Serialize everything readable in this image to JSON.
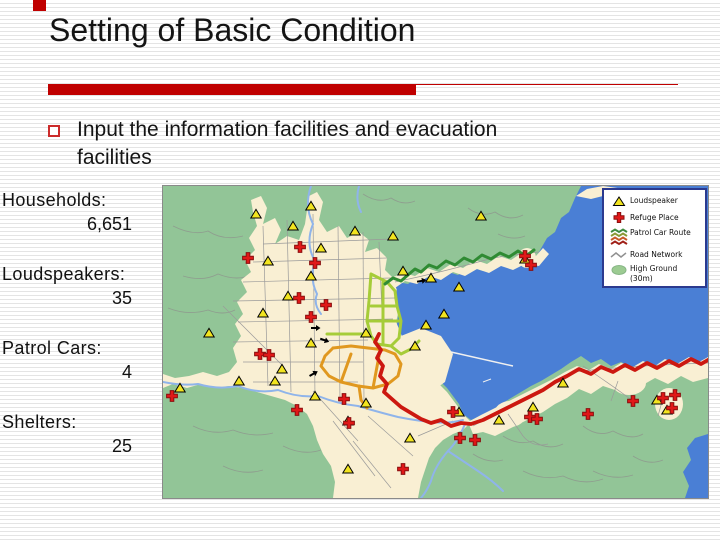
{
  "slide": {
    "title": "Setting of Basic Condition",
    "bullet_text": "Input the information facilities and evacuation facilities",
    "accent_color": "#c00000"
  },
  "stats": [
    {
      "label": "Households:",
      "value": "6,651"
    },
    {
      "label": "Loudspeakers:",
      "value": "35"
    },
    {
      "label": "Patrol Cars:",
      "value": "4"
    },
    {
      "label": "Shelters:",
      "value": "25"
    }
  ],
  "map": {
    "legend": {
      "items": [
        {
          "icon": "loudspeaker-triangle-icon",
          "label": "Loudspeaker"
        },
        {
          "icon": "refuge-cross-icon",
          "label": "Refuge Place"
        },
        {
          "icon": "patrol-route-icon",
          "label": "Patrol Car Route"
        },
        {
          "icon": "road-network-icon",
          "label": "Road Network"
        },
        {
          "icon": "high-ground-icon",
          "label": "High Ground (30m)"
        }
      ]
    },
    "colors": {
      "water": "#4a7fd5",
      "lowland": "#f9efd3",
      "high_ground": "#92c597",
      "road": "#9a9a9a",
      "river": "#8fb4ea",
      "route_green": "#2f8b33",
      "route_yellowgreen": "#a6cc38",
      "route_orange": "#e0981f",
      "route_red": "#cc1810",
      "loudspeaker_fill": "#f2e41f",
      "refuge_fill": "#e01818",
      "legend_border": "#2b3a8f"
    },
    "markers": {
      "loudspeakers": [
        [
          93,
          28
        ],
        [
          130,
          40
        ],
        [
          148,
          20
        ],
        [
          192,
          45
        ],
        [
          318,
          30
        ],
        [
          105,
          75
        ],
        [
          158,
          62
        ],
        [
          230,
          50
        ],
        [
          240,
          85
        ],
        [
          268,
          92
        ],
        [
          296,
          101
        ],
        [
          281,
          128
        ],
        [
          263,
          139
        ],
        [
          362,
          73
        ],
        [
          46,
          147
        ],
        [
          125,
          110
        ],
        [
          100,
          127
        ],
        [
          148,
          90
        ],
        [
          17,
          202
        ],
        [
          76,
          195
        ],
        [
          112,
          195
        ],
        [
          119,
          183
        ],
        [
          148,
          157
        ],
        [
          203,
          147
        ],
        [
          252,
          160
        ],
        [
          203,
          217
        ],
        [
          152,
          210
        ],
        [
          185,
          235
        ],
        [
          185,
          283
        ],
        [
          247,
          252
        ],
        [
          296,
          226
        ],
        [
          336,
          234
        ],
        [
          370,
          221
        ],
        [
          400,
          197
        ],
        [
          494,
          214
        ],
        [
          504,
          224
        ]
      ],
      "refuges": [
        [
          85,
          72
        ],
        [
          137,
          61
        ],
        [
          152,
          77
        ],
        [
          136,
          112
        ],
        [
          163,
          119
        ],
        [
          148,
          131
        ],
        [
          97,
          168
        ],
        [
          106,
          169
        ],
        [
          9,
          210
        ],
        [
          134,
          224
        ],
        [
          181,
          213
        ],
        [
          186,
          237
        ],
        [
          240,
          283
        ],
        [
          290,
          226
        ],
        [
          297,
          252
        ],
        [
          312,
          254
        ],
        [
          367,
          231
        ],
        [
          374,
          233
        ],
        [
          425,
          228
        ],
        [
          470,
          215
        ],
        [
          500,
          212
        ],
        [
          509,
          222
        ],
        [
          512,
          209
        ],
        [
          362,
          70
        ],
        [
          368,
          79
        ]
      ],
      "patrol_arrows": [
        [
          152,
          142,
          180
        ],
        [
          161,
          154,
          200
        ],
        [
          258,
          95,
          170
        ],
        [
          150,
          188,
          150
        ]
      ]
    }
  }
}
